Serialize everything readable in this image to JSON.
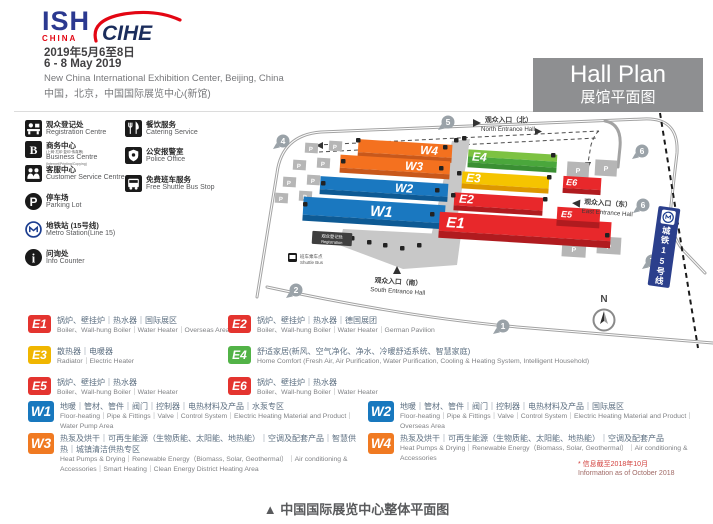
{
  "header": {
    "ish": "ISH",
    "ish_sub": "CHINA",
    "cihe": "CIHE",
    "date_cn": "2019年5月6至8日",
    "date_en": "6 - 8 May 2019",
    "venue_en": "New China International Exhibition Center, Beijing, China",
    "venue_cn": "中国，北京，中国国际展览中心(新馆)",
    "hall_plan_en": "Hall Plan",
    "hall_plan_cn": "展馆平面图"
  },
  "facilities": {
    "col1": [
      {
        "cn": "观众登记处",
        "en": "Registration Centre"
      },
      {
        "cn": "商务中心",
        "cn_sub": "(上网·打印·复印·传真等)",
        "en": "Business Centre",
        "en_sub": "(Internet/Printing/Copying)"
      },
      {
        "cn": "客服中心",
        "en": "Customer Service Centre"
      },
      {
        "cn": "停车场",
        "en": "Parking Lot"
      },
      {
        "cn": "地铁站 (15号线)",
        "en": "Metro Station(Line 15)"
      },
      {
        "cn": "问询处",
        "en": "Info Counter"
      }
    ],
    "col2": [
      {
        "cn": "餐饮服务",
        "en": "Catering Service"
      },
      {
        "cn": "公安报警室",
        "en": "Police Office"
      },
      {
        "cn": "免费班车服务",
        "en": "Free Shuttle Bus Stop"
      }
    ]
  },
  "map": {
    "halls": {
      "w1": "W1",
      "w2": "W2",
      "w3": "W3",
      "w4": "W4",
      "e1": "E1",
      "e2": "E2",
      "e3": "E3",
      "e4": "E4",
      "e5": "E5",
      "e6": "E6"
    },
    "hall_colors": {
      "blue_roof": "#1a78c0",
      "blue_front": "#0e5a94",
      "orange_roof": "#f4711f",
      "orange_front": "#c8581b",
      "red_roof": "#e8282b",
      "red_front": "#b01b1f",
      "yellow_roof": "#f5c400",
      "yellow_front": "#dd9700",
      "green_roof": "#7dc242",
      "green_roof2": "#4aa73c",
      "green_front": "#3a8f33"
    },
    "entrances": {
      "north_cn": "观众入口（北）",
      "north_en": "North Entrance Hall",
      "east_cn": "观众入口（东）",
      "east_en": "East Entrance Hall",
      "south_cn": "观众入口（南）",
      "south_en": "South Entrance Hall"
    },
    "gates": {
      "g1": "1",
      "g2": "2",
      "g4": "4",
      "g5": "5",
      "g6a": "6",
      "g6b": "6",
      "g7": "7"
    },
    "parking_label": "P",
    "metro_line_label": "城铁15号线",
    "registration_cn": "观众登记处",
    "registration_en": "Registration",
    "shuttle_cn": "班车乘车点",
    "shuttle_en": "Shuttle Bus",
    "compass_n": "N"
  },
  "legend": {
    "e_rows": [
      {
        "code": "E1",
        "color": "#e4342f",
        "cn": "锅炉、壁挂炉｜热水器｜国际展区",
        "en": "Boiler、Wall-hung Boiler｜Water Heater｜Overseas Area"
      },
      {
        "code": "E2",
        "color": "#e4342f",
        "cn": "锅炉、壁挂炉｜热水器｜德国展团",
        "en": "Boiler、Wall-hung Boiler｜Water Heater｜German Pavilion"
      },
      {
        "code": "E3",
        "color": "#f0b600",
        "cn": "散热器｜电暖器",
        "en": "Radiator｜Electric Heater"
      },
      {
        "code": "E4",
        "color": "#52b347",
        "cn": "舒适家居(新风、空气净化、净水、冷暖舒适系统、智慧家庭)",
        "en": "Home Comfort (Fresh Air, Air Purification, Water Purification, Cooling & Heating System, Intelligent Household)"
      },
      {
        "code": "E5",
        "color": "#e4342f",
        "cn": "锅炉、壁挂炉｜热水器",
        "en": "Boiler、Wall-hung Boiler｜Water Heater"
      },
      {
        "code": "E6",
        "color": "#e4342f",
        "cn": "锅炉、壁挂炉｜热水器",
        "en": "Boiler、Wall-hung Boiler｜Water Heater"
      }
    ],
    "w_rows": [
      {
        "code": "W1",
        "color": "#1878be",
        "cn": "地暖｜管材、管件｜阀门｜控制器｜电热材料及产品｜水泵专区",
        "en": "Floor-heating｜Pipe & Fittings｜Valve｜Control System｜Electric Heating Material and Product｜Water Pump Area"
      },
      {
        "code": "W2",
        "color": "#1878be",
        "cn": "地暖｜管材、管件｜阀门｜控制器｜电热材料及产品｜国际展区",
        "en": "Floor-heating｜Pipe & Fittings｜Valve｜Control System｜Electric Heating Material and Product｜Overseas Area"
      },
      {
        "code": "W3",
        "color": "#f07a22",
        "cn": "热泵及烘干｜可再生能源（生物质能、太阳能、地热能）｜空调及配套产品｜智慧供热｜城镇清洁供热专区",
        "en": "Heat Pumps & Drying｜Renewable Energy（Biomass, Solar, Geothermal）｜Air conditioning & Accessories｜Smart Heating｜Clean Energy District Heating Area"
      },
      {
        "code": "W4",
        "color": "#f07a22",
        "cn": "热泵及烘干｜可再生能源（生物质能、太阳能、地热能）｜空调及配套产品",
        "en": "Heat Pumps & Drying｜Renewable Energy（Biomass, Solar, Geothermal）｜Air conditioning & Accessories"
      }
    ],
    "note_cn": "* 信息截至2018年10月",
    "note_en": "Information as of October 2018"
  },
  "caption": "▲  中国国际展览中心整体平面图"
}
